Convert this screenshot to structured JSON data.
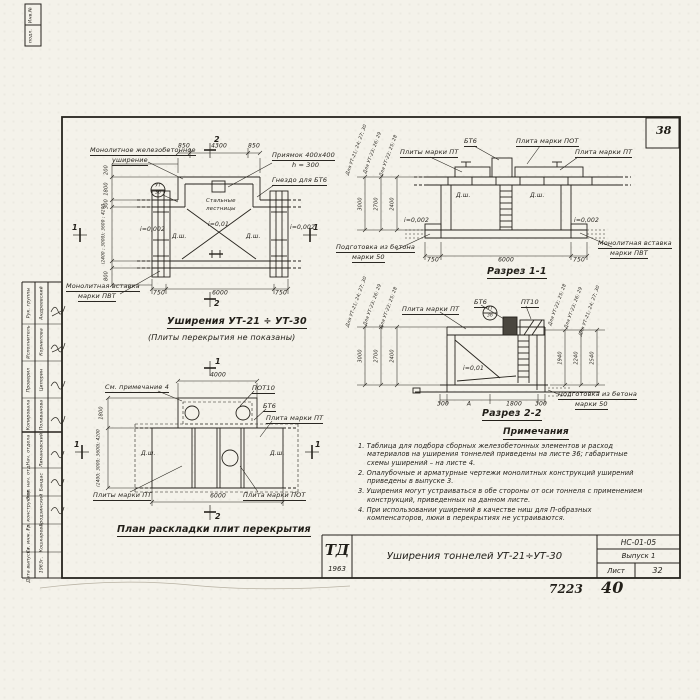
{
  "sheet": {
    "corner_number": "38",
    "doc_number": "7223",
    "page_number": "40"
  },
  "titleblock": {
    "logo_top": "ТД",
    "logo_year": "1963",
    "title": "Уширения тоннелей УТ-21÷УТ-30",
    "doc_code": "НС-01-05",
    "issue": "Выпуск 1",
    "sheet_label": "Лист",
    "sheet_number": "32"
  },
  "stamp_left": {
    "top_note1": "Инв.№",
    "top_note2": "подл.",
    "group1": [
      {
        "role": "Рук. группы",
        "name": "Андреевский"
      },
      {
        "role": "Исполнитель",
        "name": "Корнилова"
      },
      {
        "role": "Проверил",
        "name": "Ципорин"
      },
      {
        "role": "Копировала",
        "name": "Поливанова"
      }
    ],
    "group2": [
      {
        "role": "Нач. отдела",
        "name": "Лимановский"
      },
      {
        "role": "Зам. нач. отд.",
        "name": "Бандас"
      },
      {
        "role": "Гл. конструктор",
        "name": "Гродзинский"
      },
      {
        "role": "Ст. инж. гр.",
        "name": "Кошкарева"
      },
      {
        "role": "Дата выпуска",
        "name": "1963г."
      }
    ]
  },
  "plan_widening": {
    "title": "Уширения УТ-21 ÷ УТ-30",
    "subtitle": "(Плиты перекрытия не показаны)",
    "label_monolithic_1": "Монолитное железобетонное",
    "label_monolithic_2": "уширение",
    "label_pit_1": "Приямок 400х400",
    "label_pit_2": "h = 300",
    "label_socket": "Гнездо для БТ6",
    "label_ladders_1": "Стальные",
    "label_ladders_2": "лестницы",
    "label_insert_1": "Монолитная вставка",
    "label_insert_2": "марки ПВТ",
    "slope_center": "i=0,01",
    "slope_left": "i=0,002",
    "slope_right": "i=0,002",
    "dsh": "Д.ш.",
    "detail_top": "УТ",
    "detail_bottom": "36",
    "dim_top_left": "850",
    "dim_top_mid": "4300",
    "dim_top_right": "850",
    "dim_bot_left": "750",
    "dim_bot_mid": "6000",
    "dim_bot_right": "750",
    "dim_left_1": "200",
    "dim_left_2": "1800",
    "dim_left_3": "300",
    "dim_left_4": "(2400 ; 3000); 3600 ; 4200",
    "dim_left_5": "800",
    "mark_1": "1",
    "mark_2": "2"
  },
  "section11": {
    "title": "Разрез 1-1",
    "label_plates_pt": "Плиты марки ПТ",
    "label_bt6": "БТ6",
    "label_plate_pot": "Плита марки ПОТ",
    "label_plate_pt": "Плита марки ПТ",
    "dsh": "Д.ш.",
    "slope_left": "i=0,002",
    "slope_right": "i=0,002",
    "label_prep_1": "Подготовка из бетона",
    "label_prep_2": "марки 50",
    "label_insert_1": "Монолитная вставка",
    "label_insert_2": "марки ПВТ",
    "dim_bot_left": "750",
    "dim_bot_mid": "6000",
    "dim_bot_right": "750",
    "left_dims": [
      {
        "for": "Для УТ-21; 24; 27; 30",
        "value": "3000"
      },
      {
        "for": "Для УТ-23; 26; 29",
        "value": "2700"
      },
      {
        "for": "Для УТ-22; 25; 28",
        "value": "2400"
      }
    ]
  },
  "section22": {
    "title": "Разрез 2-2",
    "label_plate_pt": "Плита марки ПТ",
    "label_bt6": "БТ6",
    "label_pt10": "ПТ10",
    "detail_top": "УТ",
    "detail_bottom": "36",
    "slope": "i=0,01",
    "dim_1": "300",
    "dim_2": "А",
    "dim_3": "1800",
    "dim_4": "300",
    "label_prep_1": "Подготовка из бетона",
    "label_prep_2": "марки 50",
    "left_dims": [
      {
        "for": "Для УТ-21; 24; 27; 30",
        "value": "3000"
      },
      {
        "for": "Для УТ-23; 26; 29",
        "value": "2700"
      },
      {
        "for": "Для УТ-22; 25; 28",
        "value": "2400"
      }
    ],
    "right_dims": [
      {
        "for": "Для УТ-22; 25; 28",
        "value": "1940"
      },
      {
        "for": "Для УТ-23; 26; 29",
        "value": "2240"
      },
      {
        "for": "Для УТ-21; 24; 27; 30",
        "value": "2540"
      }
    ]
  },
  "plan_slabs": {
    "title": "План раскладки плит перекрытия",
    "label_note": "См. примечание 4",
    "label_pot10": "ПОТ10",
    "label_bt6": "БТ6",
    "label_plate_pt": "Плита марки ПТ",
    "label_plates_pt": "Плиты марки ПТ",
    "label_plate_pot": "Плита марки ПОТ",
    "dsh": "Д.ш.",
    "dim_top": "4000",
    "dim_bottom": "6000",
    "dim_left_1": "1800",
    "dim_left_2": "(2400; 3000; 3600); 4200",
    "mark_1": "1",
    "mark_2": "2"
  },
  "notes": {
    "title": "Примечания",
    "items": [
      "1. Таблица для подбора сборных железобетонных элементов и расход материалов на уширения тоннелей приведены на листе 36; габаритные схемы уширений – на листе 4.",
      "2. Опалубочные и арматурные чертежи монолитных конструкций уширений приведены в выпуске 3.",
      "3. Уширения могут устраиваться в обе стороны от оси тоннеля с применением конструкций, приведенных на данном листе.",
      "4. При использовании уширений в качестве ниш для П-образных компенсаторов, люки в перекрытиях не устраиваются."
    ]
  }
}
